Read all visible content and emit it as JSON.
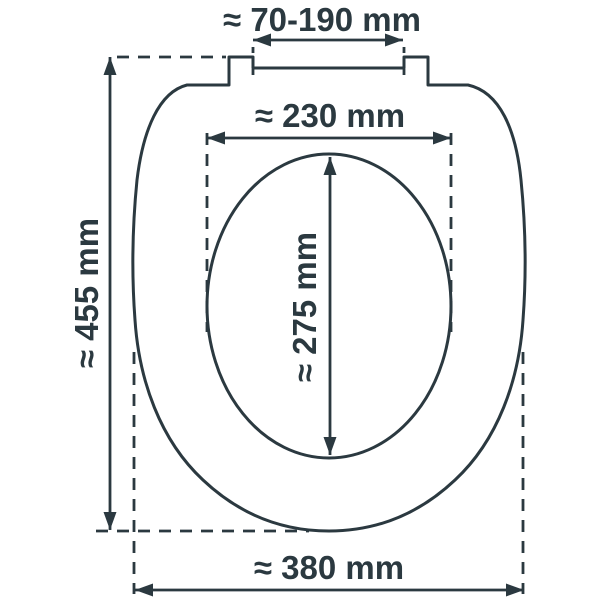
{
  "diagram": {
    "subject": "toilet-seat-dimension-diagram",
    "unit": "mm",
    "colors": {
      "ink": "#2b3940",
      "background": "#ffffff"
    },
    "measurements": {
      "hinge_spacing": {
        "label": "≈ 70-190 mm",
        "approx": true,
        "min_mm": 70,
        "max_mm": 190
      },
      "inner_width": {
        "label": "≈ 230 mm",
        "approx": true,
        "value_mm": 230
      },
      "inner_length": {
        "label": "≈ 275 mm",
        "approx": true,
        "value_mm": 275
      },
      "overall_length": {
        "label": "≈ 455 mm",
        "approx": true,
        "value_mm": 455
      },
      "overall_width": {
        "label": "≈ 380 mm",
        "approx": true,
        "value_mm": 380
      }
    }
  }
}
